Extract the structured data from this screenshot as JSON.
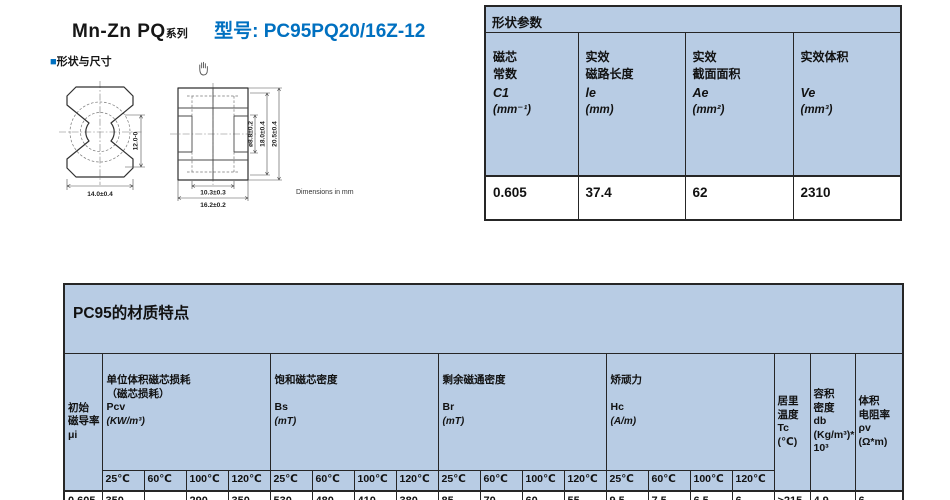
{
  "header": {
    "series": "Mn-Zn  PQ",
    "series_suffix": "系列",
    "model": "型号: PC95PQ20/16Z-12",
    "section_square": "■",
    "section_label": "形状与尺寸",
    "accent_blue": "#0070c0",
    "table_blue": "#b8cce4"
  },
  "drawing": {
    "note": "Dimensions in mm",
    "hand_icon": "grab-hand-icon",
    "front": {
      "dim_height": "12.0-0",
      "dim_width": "14.0±0.4"
    },
    "side": {
      "dim_hole": "ø8.8±0.2",
      "dim_inner": "18.0±0.4",
      "dim_outer": "20.5±0.4",
      "dim_inner_w": "10.3±0.3",
      "dim_outer_w": "16.2±0.2"
    }
  },
  "shape_table": {
    "title": "形状参数",
    "columns": [
      {
        "name": "磁芯\n常数",
        "symbol": "C1",
        "unit": "(mm⁻¹)"
      },
      {
        "name": "实效\n磁路长度",
        "symbol": "le",
        "unit": "(mm)"
      },
      {
        "name": "实效\n截面面积",
        "symbol": "Ae",
        "unit": "(mm²)"
      },
      {
        "name": "实效体积",
        "symbol": "Ve",
        "unit": "(mm³)"
      }
    ],
    "values": [
      "0.605",
      "37.4",
      "62",
      "2310"
    ]
  },
  "material_table": {
    "title": "PC95的材质特点",
    "mu_label": "初始\n磁导率\nμi",
    "mu_value": "0.605",
    "temps": [
      "25℃",
      "60℃",
      "100℃",
      "120℃"
    ],
    "groups": [
      {
        "name": "单位体积磁芯损耗",
        "sub": "（磁芯损耗）",
        "symbol": "Pcv",
        "unit": "(KW/m³)",
        "values": [
          "350",
          "",
          "290",
          "350"
        ]
      },
      {
        "name": "饱和磁芯密度",
        "sub": "",
        "symbol": "Bs",
        "unit": "(mT)",
        "values": [
          "530",
          "480",
          "410",
          "380"
        ]
      },
      {
        "name": "剩余磁通密度",
        "sub": "",
        "symbol": "Br",
        "unit": "(mT)",
        "values": [
          "85",
          "70",
          "60",
          "55"
        ]
      },
      {
        "name": "矫顽力",
        "sub": "",
        "symbol": "Hc",
        "unit": "(A/m)",
        "values": [
          "9.5",
          "7.5",
          "6.5",
          "6"
        ]
      }
    ],
    "tails": [
      {
        "label": "居里\n温度\nTc\n(℃)",
        "value": ">215"
      },
      {
        "label": "容积\n密度\ndb\n(Kg/m³)*10³",
        "value": "4.9"
      },
      {
        "label": "体积\n电阻率\nρv\n(Ω*m)",
        "value": "6"
      }
    ]
  }
}
